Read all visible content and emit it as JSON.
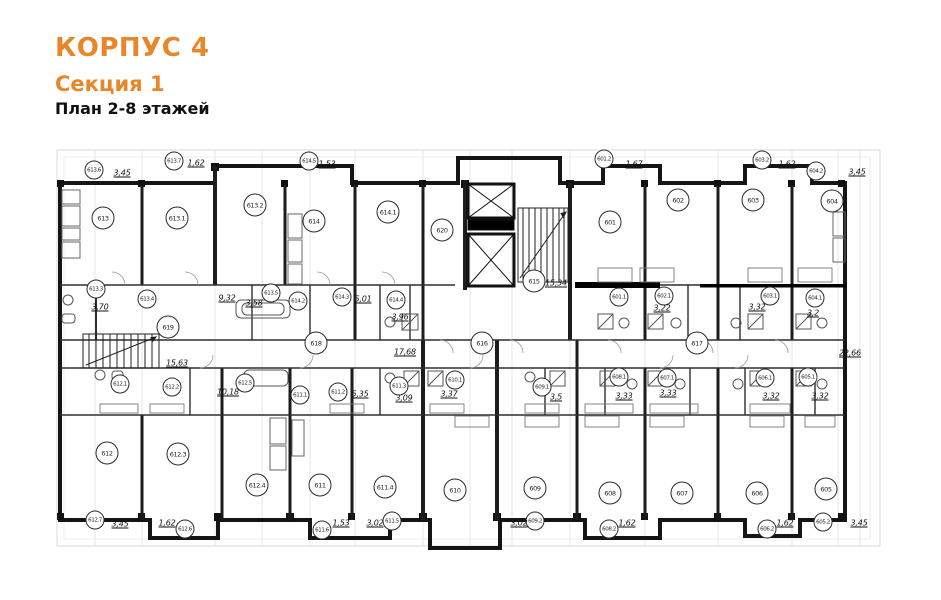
{
  "title": {
    "building": "КОРПУС 4",
    "section": "Секция 1",
    "plan_label": "План 2-8 этажей",
    "accent_color": "#e8862a"
  },
  "plan": {
    "rooms": [
      {
        "label": "613",
        "x": 103,
        "y": 218,
        "size": "lg"
      },
      {
        "label": "613.1",
        "x": 177,
        "y": 218,
        "size": "lg"
      },
      {
        "label": "613.2",
        "x": 255,
        "y": 205,
        "size": "lg"
      },
      {
        "label": "614",
        "x": 314,
        "y": 221,
        "size": "lg"
      },
      {
        "label": "614.1",
        "x": 388,
        "y": 212,
        "size": "lg"
      },
      {
        "label": "620",
        "x": 442,
        "y": 230,
        "size": "lg"
      },
      {
        "label": "601",
        "x": 610,
        "y": 222,
        "size": "lg"
      },
      {
        "label": "602",
        "x": 678,
        "y": 200,
        "size": "lg"
      },
      {
        "label": "603",
        "x": 753,
        "y": 200,
        "size": "lg"
      },
      {
        "label": "604",
        "x": 832,
        "y": 201,
        "size": "lg"
      },
      {
        "label": "615",
        "x": 534,
        "y": 281,
        "size": "lg"
      },
      {
        "label": "616",
        "x": 482,
        "y": 343,
        "size": "lg"
      },
      {
        "label": "617",
        "x": 697,
        "y": 343,
        "size": "lg"
      },
      {
        "label": "618",
        "x": 316,
        "y": 343,
        "size": "lg"
      },
      {
        "label": "619",
        "x": 168,
        "y": 327,
        "size": "lg"
      },
      {
        "label": "612",
        "x": 107,
        "y": 453,
        "size": "lg"
      },
      {
        "label": "612.3",
        "x": 178,
        "y": 454,
        "size": "lg"
      },
      {
        "label": "612.4",
        "x": 257,
        "y": 485,
        "size": "lg"
      },
      {
        "label": "611",
        "x": 320,
        "y": 485,
        "size": "lg"
      },
      {
        "label": "611.4",
        "x": 385,
        "y": 487,
        "size": "lg"
      },
      {
        "label": "610",
        "x": 455,
        "y": 490,
        "size": "lg"
      },
      {
        "label": "609",
        "x": 535,
        "y": 488,
        "size": "lg"
      },
      {
        "label": "608",
        "x": 610,
        "y": 493,
        "size": "lg"
      },
      {
        "label": "607",
        "x": 682,
        "y": 493,
        "size": "lg"
      },
      {
        "label": "606",
        "x": 757,
        "y": 493,
        "size": "lg"
      },
      {
        "label": "605",
        "x": 826,
        "y": 489,
        "size": "lg"
      },
      {
        "label": "613.6",
        "x": 94,
        "y": 170,
        "size": "sm"
      },
      {
        "label": "613.7",
        "x": 174,
        "y": 161,
        "size": "sm"
      },
      {
        "label": "614.5",
        "x": 309,
        "y": 161,
        "size": "sm"
      },
      {
        "label": "601.2",
        "x": 604,
        "y": 159,
        "size": "sm"
      },
      {
        "label": "603.2",
        "x": 762,
        "y": 160,
        "size": "sm"
      },
      {
        "label": "604.2",
        "x": 816,
        "y": 171,
        "size": "sm"
      },
      {
        "label": "613.3",
        "x": 96,
        "y": 289,
        "size": "sm"
      },
      {
        "label": "613.4",
        "x": 147,
        "y": 299,
        "size": "sm"
      },
      {
        "label": "613.5",
        "x": 271,
        "y": 293,
        "size": "sm"
      },
      {
        "label": "614.2",
        "x": 298,
        "y": 301,
        "size": "sm"
      },
      {
        "label": "614.3",
        "x": 342,
        "y": 297,
        "size": "sm"
      },
      {
        "label": "614.4",
        "x": 396,
        "y": 300,
        "size": "sm"
      },
      {
        "label": "601.1",
        "x": 619,
        "y": 297,
        "size": "sm"
      },
      {
        "label": "602.1",
        "x": 664,
        "y": 296,
        "size": "sm"
      },
      {
        "label": "603.1",
        "x": 770,
        "y": 296,
        "size": "sm"
      },
      {
        "label": "604.1",
        "x": 815,
        "y": 298,
        "size": "sm"
      },
      {
        "label": "612.1",
        "x": 120,
        "y": 384,
        "size": "sm"
      },
      {
        "label": "612.2",
        "x": 172,
        "y": 387,
        "size": "sm"
      },
      {
        "label": "612.5",
        "x": 245,
        "y": 383,
        "size": "sm"
      },
      {
        "label": "611.1",
        "x": 300,
        "y": 395,
        "size": "sm"
      },
      {
        "label": "611.2",
        "x": 338,
        "y": 392,
        "size": "sm"
      },
      {
        "label": "611.3",
        "x": 399,
        "y": 386,
        "size": "sm"
      },
      {
        "label": "610.1",
        "x": 455,
        "y": 380,
        "size": "sm"
      },
      {
        "label": "609.1",
        "x": 542,
        "y": 387,
        "size": "sm"
      },
      {
        "label": "608.1",
        "x": 619,
        "y": 377,
        "size": "sm"
      },
      {
        "label": "607.1",
        "x": 667,
        "y": 378,
        "size": "sm"
      },
      {
        "label": "606.1",
        "x": 765,
        "y": 378,
        "size": "sm"
      },
      {
        "label": "605.1",
        "x": 808,
        "y": 377,
        "size": "sm"
      },
      {
        "label": "612.7",
        "x": 95,
        "y": 520,
        "size": "sm"
      },
      {
        "label": "612.6",
        "x": 185,
        "y": 529,
        "size": "sm"
      },
      {
        "label": "611.6",
        "x": 322,
        "y": 530,
        "size": "sm"
      },
      {
        "label": "611.5",
        "x": 392,
        "y": 521,
        "size": "sm"
      },
      {
        "label": "609.2",
        "x": 535,
        "y": 521,
        "size": "sm"
      },
      {
        "label": "608.2",
        "x": 609,
        "y": 529,
        "size": "sm"
      },
      {
        "label": "606.2",
        "x": 767,
        "y": 529,
        "size": "sm"
      },
      {
        "label": "605.2",
        "x": 823,
        "y": 522,
        "size": "sm"
      }
    ],
    "dims": [
      {
        "text": "3,45",
        "x": 122,
        "y": 173
      },
      {
        "text": "1,62",
        "x": 196,
        "y": 163
      },
      {
        "text": "1,53",
        "x": 327,
        "y": 164
      },
      {
        "text": "1,67",
        "x": 634,
        "y": 164
      },
      {
        "text": "1,62",
        "x": 787,
        "y": 164
      },
      {
        "text": "3,45",
        "x": 857,
        "y": 172
      },
      {
        "text": "3,70",
        "x": 100,
        "y": 307
      },
      {
        "text": "9,32",
        "x": 227,
        "y": 298
      },
      {
        "text": "3,58",
        "x": 254,
        "y": 303
      },
      {
        "text": "5,01",
        "x": 363,
        "y": 299
      },
      {
        "text": "3,96",
        "x": 400,
        "y": 317
      },
      {
        "text": "15,34",
        "x": 556,
        "y": 283
      },
      {
        "text": "3,22",
        "x": 662,
        "y": 308
      },
      {
        "text": "3,32",
        "x": 757,
        "y": 307
      },
      {
        "text": "3,2",
        "x": 813,
        "y": 313
      },
      {
        "text": "15,63",
        "x": 177,
        "y": 363
      },
      {
        "text": "17,68",
        "x": 405,
        "y": 352
      },
      {
        "text": "22,66",
        "x": 850,
        "y": 353
      },
      {
        "text": "10,18",
        "x": 228,
        "y": 392
      },
      {
        "text": "5,35",
        "x": 360,
        "y": 394
      },
      {
        "text": "3,09",
        "x": 404,
        "y": 398
      },
      {
        "text": "3,37",
        "x": 449,
        "y": 394
      },
      {
        "text": "3,5",
        "x": 556,
        "y": 397
      },
      {
        "text": "3,33",
        "x": 624,
        "y": 396
      },
      {
        "text": "3,33",
        "x": 668,
        "y": 393
      },
      {
        "text": "3,32",
        "x": 771,
        "y": 396
      },
      {
        "text": "3,32",
        "x": 820,
        "y": 396
      },
      {
        "text": "3,45",
        "x": 120,
        "y": 524
      },
      {
        "text": "1,62",
        "x": 167,
        "y": 523
      },
      {
        "text": "1,53",
        "x": 341,
        "y": 523
      },
      {
        "text": "3,02",
        "x": 375,
        "y": 523
      },
      {
        "text": "3,02",
        "x": 519,
        "y": 523
      },
      {
        "text": "1,62",
        "x": 627,
        "y": 523
      },
      {
        "text": "1,62",
        "x": 785,
        "y": 523
      },
      {
        "text": "3,45",
        "x": 859,
        "y": 523
      }
    ]
  }
}
